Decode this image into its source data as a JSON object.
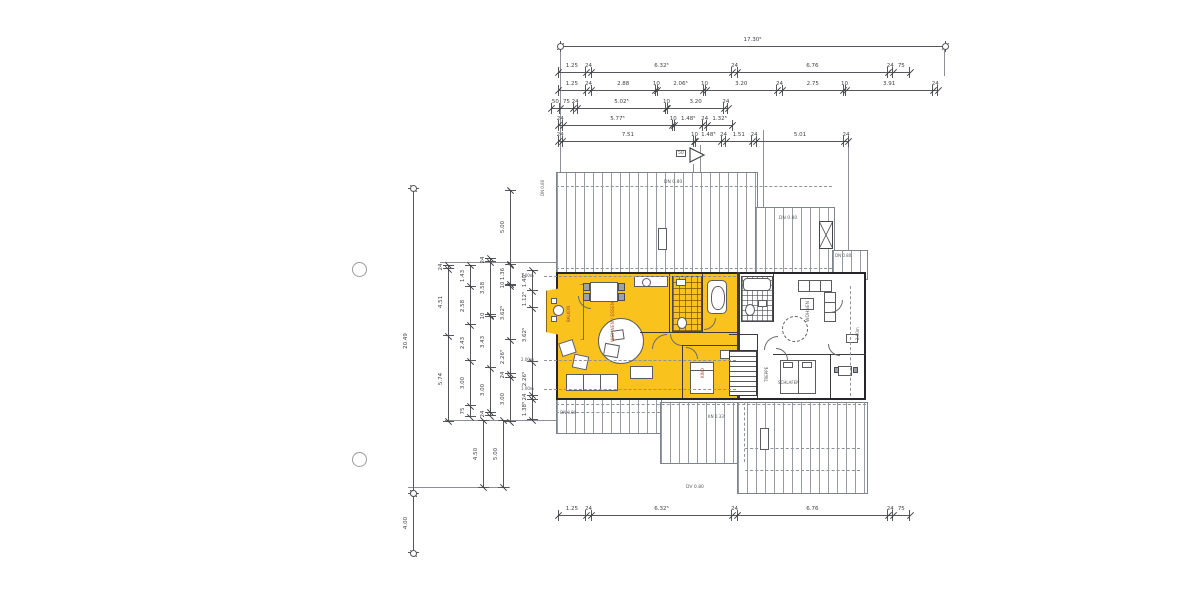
{
  "page": {
    "background": "#ffffff"
  },
  "scan": {
    "accent_yellow": "#F9C21D",
    "line_color": "#55575c",
    "hole_punches": 2
  },
  "section_marker": {
    "label": "50"
  },
  "roof": {
    "dn_top": "DN 0.80",
    "dn_mid": "DN 0.80",
    "dn_right": "DN 0.80",
    "dn_bottom_left": "DN 0.80",
    "dn_left_edge": "DN 0.80",
    "kn": "KN 0.33⁵",
    "dv": "DV 0.80"
  },
  "heights": {
    "h1": "1.00m",
    "h2": "2.00m",
    "h3": "1.00m",
    "h_right": "2.00m"
  },
  "rooms": {
    "balcony": "BALKON",
    "living1": "WOHNEN / ESSEN",
    "bath1": "BAD",
    "kid": "KIND",
    "stair": "TREPPE",
    "living2": "WOHNEN",
    "sleep2": "SCHLAFEN"
  },
  "dim_chains": [
    {
      "id": "top-overall",
      "orient": "h",
      "x": 560,
      "y": 46,
      "scale": 22.25,
      "circles": true,
      "segments": [
        {
          "v": 17.305,
          "label": "17.30⁵"
        }
      ]
    },
    {
      "id": "top-r2",
      "orient": "h",
      "x": 558,
      "y": 72,
      "scale": 22.25,
      "circles": false,
      "segments": [
        {
          "v": 1.25,
          "label": "1.25"
        },
        {
          "v": 0.24,
          "label": "24"
        },
        {
          "v": 6.325,
          "label": "6.32⁵"
        },
        {
          "v": 0.24,
          "label": "24"
        },
        {
          "v": 6.76,
          "label": "6.76"
        },
        {
          "v": 0.24,
          "label": "24"
        },
        {
          "v": 0.75,
          "label": "75"
        }
      ]
    },
    {
      "id": "top-r3",
      "orient": "h",
      "x": 558,
      "y": 90,
      "scale": 22.25,
      "circles": false,
      "segments": [
        {
          "v": 1.25,
          "label": "1.25"
        },
        {
          "v": 0.24,
          "label": "24"
        },
        {
          "v": 2.88,
          "label": "2.88"
        },
        {
          "v": 0.1,
          "label": "10"
        },
        {
          "v": 2.065,
          "label": "2.06⁵"
        },
        {
          "v": 0.1,
          "label": "10"
        },
        {
          "v": 3.2,
          "label": "3.20"
        },
        {
          "v": 0.24,
          "label": "24"
        },
        {
          "v": 2.75,
          "label": "2.75"
        },
        {
          "v": 0.1,
          "label": "10"
        },
        {
          "v": 3.91,
          "label": "3.91"
        },
        {
          "v": 0.24,
          "label": "24"
        }
      ]
    },
    {
      "id": "top-r4",
      "orient": "h",
      "x": 551,
      "y": 108,
      "scale": 17.6,
      "circles": false,
      "segments": [
        {
          "v": 0.5,
          "label": "50"
        },
        {
          "v": 0.75,
          "label": "75"
        },
        {
          "v": 0.24,
          "label": "24"
        },
        {
          "v": 5.025,
          "label": "5.02⁵"
        },
        {
          "v": 0.1,
          "label": "10"
        },
        {
          "v": 3.2,
          "label": "3.20"
        },
        {
          "v": 0.24,
          "label": "24"
        }
      ]
    },
    {
      "id": "top-r5",
      "orient": "h",
      "x": 558,
      "y": 125,
      "scale": 19,
      "circles": false,
      "segments": [
        {
          "v": 0.24,
          "label": "24"
        },
        {
          "v": 5.775,
          "label": "5.77⁵"
        },
        {
          "v": 0.1,
          "label": "10"
        },
        {
          "v": 1.485,
          "label": "1.48⁵"
        },
        {
          "v": 0.24,
          "label": "24"
        },
        {
          "v": 1.325,
          "label": "1.32⁵"
        }
      ]
    },
    {
      "id": "top-r6",
      "orient": "h",
      "x": 558,
      "y": 141,
      "scale": 17.5,
      "circles": false,
      "segments": [
        {
          "v": 0.24,
          "label": "24"
        },
        {
          "v": 7.51,
          "label": "7.51"
        },
        {
          "v": 0.1,
          "label": "10"
        },
        {
          "v": 1.485,
          "label": "1.48⁵"
        },
        {
          "v": 0.24,
          "label": "24"
        },
        {
          "v": 1.51,
          "label": "1.51"
        },
        {
          "v": 0.24,
          "label": "24"
        },
        {
          "v": 5.01,
          "label": "5.01"
        },
        {
          "v": 0.24,
          "label": "24"
        }
      ]
    },
    {
      "id": "left-overall",
      "orient": "v",
      "x": 413,
      "y": 188,
      "scale": 14.9,
      "circles": true,
      "segments": [
        {
          "v": 20.49,
          "label": "20.49"
        }
      ]
    },
    {
      "id": "left-lower",
      "orient": "v",
      "x": 413,
      "y": 493,
      "scale": 14.9,
      "circles": true,
      "segments": [
        {
          "v": 4.0,
          "label": "4.00"
        }
      ]
    },
    {
      "id": "l1",
      "orient": "v",
      "x": 448,
      "y": 265,
      "scale": 14.9,
      "circles": false,
      "segments": [
        {
          "v": 0.24,
          "label": "24"
        },
        {
          "v": 4.51,
          "label": "4.51"
        },
        {
          "v": 5.74,
          "label": "5.74"
        }
      ]
    },
    {
      "id": "l2",
      "orient": "v",
      "x": 470,
      "y": 265,
      "scale": 14.9,
      "circles": false,
      "segments": [
        {
          "v": 1.43,
          "label": "1.43"
        },
        {
          "v": 2.58,
          "label": "2.58"
        },
        {
          "v": 2.43,
          "label": "2.43"
        },
        {
          "v": 3.0,
          "label": "3.00"
        },
        {
          "v": 0.75,
          "label": "75"
        }
      ]
    },
    {
      "id": "l3",
      "orient": "v",
      "x": 490,
      "y": 258,
      "scale": 14.9,
      "circles": false,
      "segments": [
        {
          "v": 0.24,
          "label": "24"
        },
        {
          "v": 3.58,
          "label": "3.58"
        },
        {
          "v": 0.1,
          "label": "10"
        },
        {
          "v": 3.43,
          "label": "3.43"
        },
        {
          "v": 3.0,
          "label": "3.00"
        },
        {
          "v": 0.24,
          "label": "24"
        }
      ]
    },
    {
      "id": "l3b",
      "orient": "v",
      "x": 483,
      "y": 420,
      "scale": 14.9,
      "circles": false,
      "segments": [
        {
          "v": 4.5,
          "label": "4.50"
        }
      ]
    },
    {
      "id": "l4a",
      "orient": "v",
      "x": 510,
      "y": 190,
      "scale": 14.9,
      "circles": false,
      "segments": [
        {
          "v": 5.0,
          "label": "5.00"
        }
      ]
    },
    {
      "id": "l4",
      "orient": "v",
      "x": 510,
      "y": 264,
      "scale": 14.9,
      "circles": false,
      "segments": [
        {
          "v": 1.36,
          "label": "1.36"
        },
        {
          "v": 0.1,
          "label": "10"
        },
        {
          "v": 3.625,
          "label": "3.62⁵"
        },
        {
          "v": 2.265,
          "label": "2.26⁵"
        },
        {
          "v": 0.24,
          "label": "24"
        },
        {
          "v": 3.0,
          "label": "3.00"
        }
      ]
    },
    {
      "id": "l4b",
      "orient": "v",
      "x": 503,
      "y": 420,
      "scale": 14.9,
      "circles": false,
      "segments": [
        {
          "v": 4.5,
          "label": "5.00"
        }
      ]
    },
    {
      "id": "l5",
      "orient": "v",
      "x": 532,
      "y": 270,
      "scale": 14.9,
      "circles": false,
      "segments": [
        {
          "v": 1.405,
          "label": "1.40⁵"
        },
        {
          "v": 1.125,
          "label": "1.12⁵"
        },
        {
          "v": 3.625,
          "label": "3.62⁵"
        },
        {
          "v": 2.265,
          "label": "2.26⁵"
        },
        {
          "v": 0.24,
          "label": "24"
        },
        {
          "v": 1.385,
          "label": "1.38⁵"
        }
      ]
    },
    {
      "id": "bottom",
      "orient": "h",
      "x": 558,
      "y": 515,
      "scale": 22.25,
      "circles": false,
      "segments": [
        {
          "v": 1.25,
          "label": "1.25"
        },
        {
          "v": 0.24,
          "label": "24"
        },
        {
          "v": 6.325,
          "label": "6.32⁵"
        },
        {
          "v": 0.24,
          "label": "24"
        },
        {
          "v": 6.76,
          "label": "6.76"
        },
        {
          "v": 0.24,
          "label": "24"
        },
        {
          "v": 0.75,
          "label": "75"
        }
      ]
    }
  ]
}
